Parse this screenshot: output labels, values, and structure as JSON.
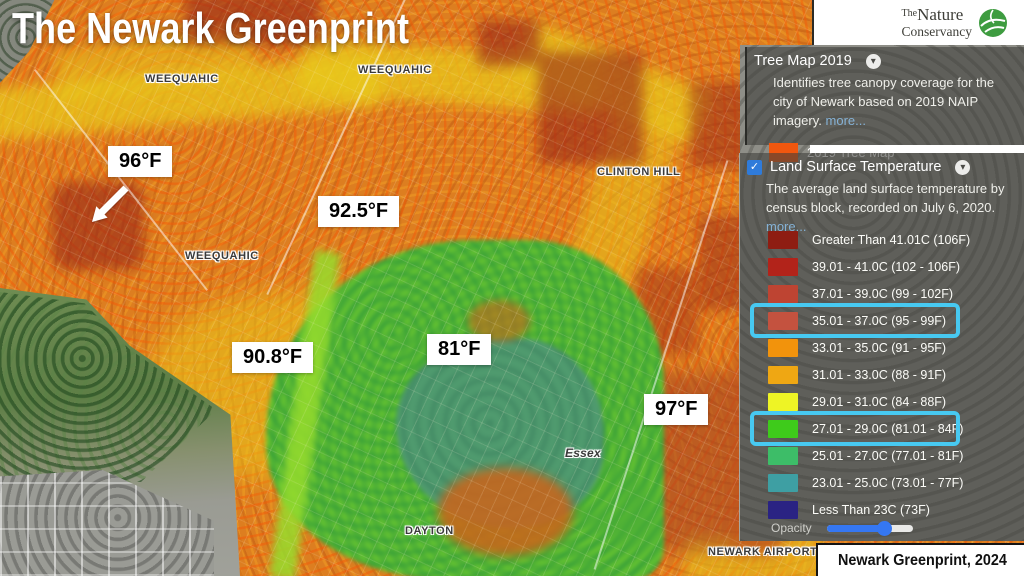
{
  "title": "The Newark Greenprint",
  "attribution": "Newark Greenprint, 2024",
  "logo": {
    "the": "The",
    "nature": "Nature",
    "conservancy": "Conservancy"
  },
  "icons": {
    "chevron_down": "▾",
    "check": "✓"
  },
  "colors": {
    "highlight_box": "#47C9F1",
    "checkbox_blue": "#2F7BDA",
    "slider_blue": "#3577F2",
    "more_link": "#85B2D6"
  },
  "map": {
    "place_labels": [
      {
        "text": "WEEQUAHIC",
        "x": 145,
        "y": 73,
        "style": "uppercase"
      },
      {
        "text": "WEEQUAHIC",
        "x": 358,
        "y": 64,
        "style": "uppercase"
      },
      {
        "text": "WEEQUAHIC",
        "x": 185,
        "y": 250,
        "style": "uppercase"
      },
      {
        "text": "CLINTON HILL",
        "x": 597,
        "y": 166,
        "style": "uppercase"
      },
      {
        "text": "Essex",
        "x": 565,
        "y": 446,
        "style": "italic"
      },
      {
        "text": "DAYTON",
        "x": 405,
        "y": 525,
        "style": "uppercase"
      },
      {
        "text": "NEWARK AIRPORT",
        "x": 708,
        "y": 546,
        "style": "uppercase"
      }
    ],
    "temperature_annotations": [
      {
        "text": "96°F",
        "x": 108,
        "y": 146,
        "arrow": true
      },
      {
        "text": "92.5°F",
        "x": 318,
        "y": 196
      },
      {
        "text": "90.8°F",
        "x": 232,
        "y": 342
      },
      {
        "text": "81°F",
        "x": 427,
        "y": 334
      },
      {
        "text": "97°F",
        "x": 644,
        "y": 394
      }
    ]
  },
  "panels": {
    "tree": {
      "title": "Tree Map 2019",
      "description": "Identifies tree canopy coverage for the city of Newark based on 2019 NAIP imagery.",
      "more_link": "more...",
      "legend_label": "2019 Tree Map",
      "legend_color": "#F0570F"
    },
    "lst": {
      "title": "Land Surface Temperature",
      "checked": true,
      "description": "The average land surface temperature by census block, recorded on July 6, 2020.",
      "more_link": "more...",
      "classes": [
        {
          "label": "Greater Than 41.01C (106F)",
          "color": "#8E1D12",
          "highlighted": false
        },
        {
          "label": "39.01 - 41.0C (102 - 106F)",
          "color": "#B2231A",
          "highlighted": false
        },
        {
          "label": "37.01 - 39.0C (99 - 102F)",
          "color": "#BE4432",
          "highlighted": false
        },
        {
          "label": "35.01 - 37.0C (95 - 99F)",
          "color": "#C4523F",
          "highlighted": true
        },
        {
          "label": "33.01 - 35.0C (91 - 95F)",
          "color": "#F2930C",
          "highlighted": false
        },
        {
          "label": "31.01 - 33.0C (88 - 91F)",
          "color": "#EFA713",
          "highlighted": false
        },
        {
          "label": "29.01 - 31.0C (84 - 88F)",
          "color": "#EEF425",
          "highlighted": false
        },
        {
          "label": "27.01 - 29.0C (81.01 - 84F)",
          "color": "#3ECB1B",
          "highlighted": true
        },
        {
          "label": "25.01 - 27.0C (77.01 - 81F)",
          "color": "#3DBD68",
          "highlighted": false
        },
        {
          "label": "23.01 - 25.0C (73.01 - 77F)",
          "color": "#3E9FA3",
          "highlighted": false
        },
        {
          "label": "Less Than 23C (73F)",
          "color": "#2A2383",
          "highlighted": false
        }
      ],
      "opacity_label": "Opacity",
      "opacity_percent": 67
    }
  }
}
